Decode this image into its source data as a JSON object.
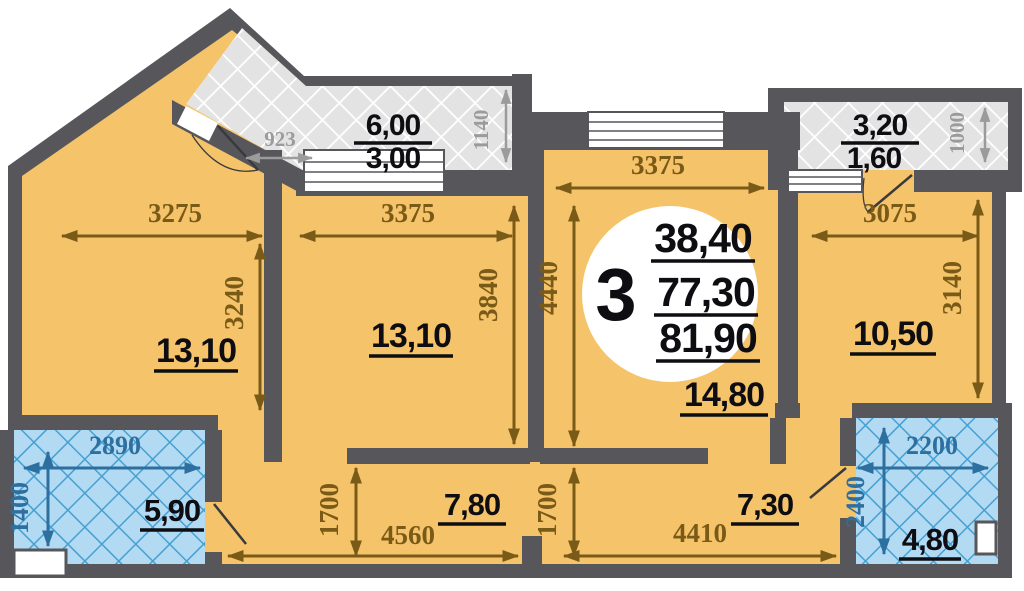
{
  "plan": {
    "badge": {
      "rooms_count": "3",
      "area_living": "38,40",
      "area_reduced": "77,30",
      "area_total": "81,90"
    },
    "rooms": {
      "left": {
        "area": "13,10",
        "width": "3275",
        "height": "3240"
      },
      "middle": {
        "area": "13,10",
        "width": "3375",
        "height": "3840"
      },
      "living": {
        "area": "14,80",
        "width": "3375",
        "height": "4440"
      },
      "right": {
        "area": "10,50",
        "width": "3075",
        "height": "3140"
      },
      "bath_left": {
        "area": "5,90",
        "width": "2890",
        "height": "1400"
      },
      "corridor_left": {
        "area": "7,80",
        "width": "4560",
        "height": "1700"
      },
      "corridor_right": {
        "area": "7,30",
        "width": "4410",
        "height": "1700"
      },
      "bath_right": {
        "area": "4,80",
        "width": "2200",
        "height": "2400"
      },
      "balcony_top": {
        "area_total": "6,00",
        "area_counted": "3,00",
        "depth": "1140",
        "side": "923"
      },
      "balcony_right": {
        "area_total": "3,20",
        "area_counted": "1,60",
        "depth": "1000"
      }
    },
    "colors": {
      "wall": "#57575b",
      "room_fill": "#f5c36a",
      "balcony_fill": "#e3e3e3",
      "balcony_lattice": "#ffffff",
      "bathroom_fill": "#b2daf2",
      "bathroom_lattice": "#46a0d2",
      "dim_primary": "#7a5a17",
      "dim_secondary": "#9b9b9b",
      "dim_bathroom": "#2d6f9e",
      "label": "#0d0d12",
      "badge_bg": "#ffffff"
    }
  }
}
